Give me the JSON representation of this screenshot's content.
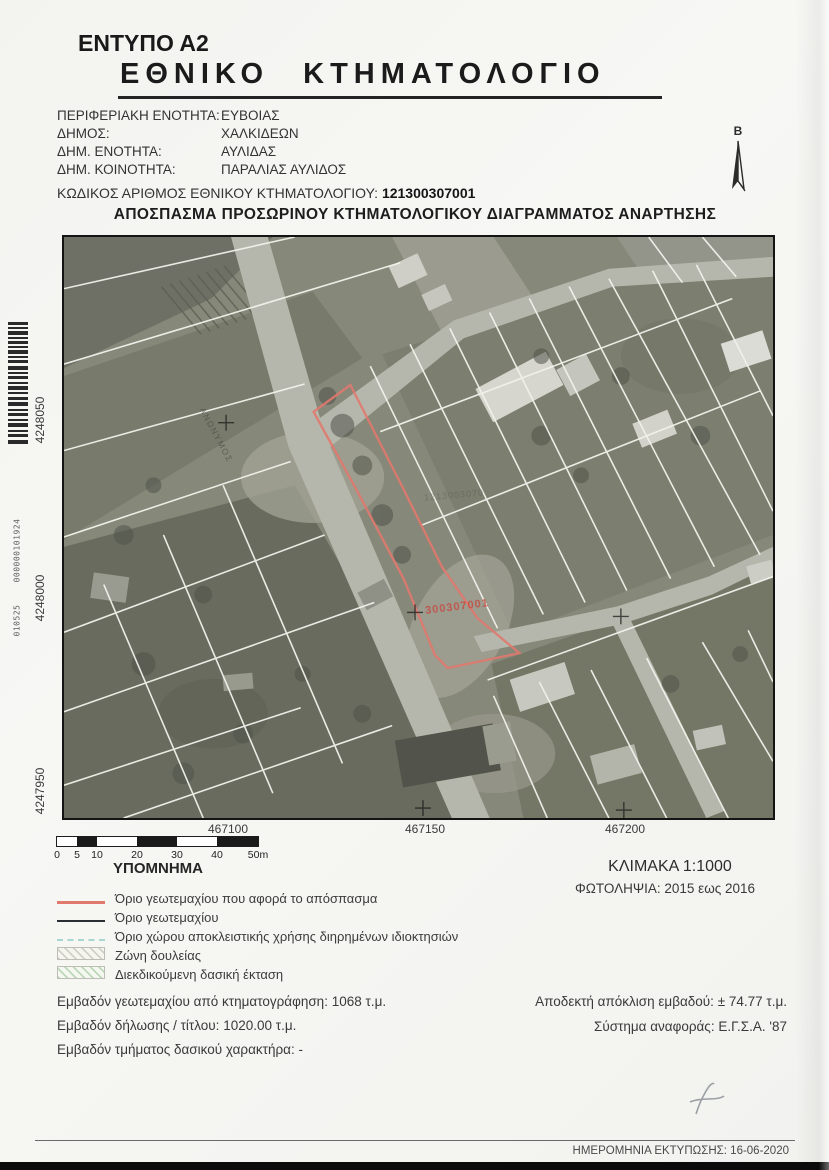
{
  "document": {
    "form_code": "ΕΝΤΥΠΟ Α2",
    "title": "ΕΘΝΙΚΟ ΚΤΗΜΑΤΟΛΟΓΙΟ",
    "map_title": "ΑΠΟΣΠΑΣΜΑ ΠΡΟΣΩΡΙΝΟΥ ΚΤΗΜΑΤΟΛΟΓΙΚΟΥ ΔΙΑΓΡΑΜΜΑΤΟΣ ΑΝΑΡΤΗΣΗΣ"
  },
  "admin": {
    "rows": [
      {
        "label": "ΠΕΡΙΦΕΡΙΑΚΗ ΕΝΟΤΗΤΑ:",
        "value": "ΕΥΒΟΙΑΣ"
      },
      {
        "label": "ΔΗΜΟΣ:",
        "value": "ΧΑΛΚΙΔΕΩΝ"
      },
      {
        "label": "ΔΗΜ. ΕΝΟΤΗΤΑ:",
        "value": "ΑΥΛΙΔΑΣ"
      },
      {
        "label": "ΔΗΜ. ΚΟΙΝΟΤΗΤΑ:",
        "value": "ΠΑΡΑΛΙΑΣ ΑΥΛΙΔΟΣ"
      }
    ],
    "kaek_label": "ΚΩΔΙΚΟΣ ΑΡΙΘΜΟΣ ΕΘΝΙΚΟΥ ΚΤΗΜΑΤΟΛΟΓΙΟΥ:",
    "kaek_value": "121300307001"
  },
  "map": {
    "north_label": "Β",
    "parcel_code_label": "300307001",
    "faint_parcel_code": "1213003070",
    "street_label": "ΑΝΩΝΥΜΟΣ",
    "x_ticks": [
      "467100",
      "467150",
      "467200"
    ],
    "y_ticks": [
      "4248050",
      "4248000",
      "4247950"
    ],
    "subject_outline_color": "#e0796e"
  },
  "scalebar": {
    "ticks": [
      "0",
      "5",
      "10",
      "20",
      "30",
      "40",
      "50m"
    ]
  },
  "legend": {
    "title": "ΥΠΟΜΝΗΜΑ",
    "items": [
      {
        "swatch": "red-line",
        "label": "Όριο γεωτεμαχίου που αφορά το απόσπασμα"
      },
      {
        "swatch": "dark-line",
        "label": "Όριο γεωτεμαχίου"
      },
      {
        "swatch": "teal-dashed-line",
        "label": "Όριο χώρου αποκλειστικής χρήσης διηρημένων ιδιοκτησιών"
      },
      {
        "swatch": "gray-hatch",
        "label": "Ζώνη δουλείας"
      },
      {
        "swatch": "green-hatch",
        "label": "Διεκδικούμενη δασική έκταση"
      }
    ]
  },
  "map_meta": {
    "scale": "ΚΛΙΜΑΚΑ 1:1000",
    "photo_dates": "ΦΩΤΟΛΗΨΙΑ: 2015 εως 2016"
  },
  "areas": {
    "left": [
      {
        "label": "Εμβαδόν γεωτεμαχίου από κτηματογράφηση:",
        "value": "1068 τ.μ."
      },
      {
        "label": "Εμβαδόν δήλωσης / τίτλου:",
        "value": "1020.00 τ.μ."
      },
      {
        "label": "Εμβαδόν τμήματος δασικού χαρακτήρα:",
        "value": "-"
      }
    ],
    "right": [
      {
        "label": "Αποδεκτή απόκλιση εμβαδού:",
        "value": "± 74.77 τ.μ."
      },
      {
        "label": "Σύστημα αναφοράς:",
        "value": "Ε.Γ.Σ.Α. '87"
      }
    ]
  },
  "footer": {
    "print_date": "ΗΜΕΡΟΜΗΝΙΑ ΕΚΤΥΠΩΣΗΣ: 16-06-2020"
  },
  "scan_artifacts": {
    "barcode_number": "000000101924",
    "batch_number": "010525"
  },
  "colors": {
    "subject_parcel": "#e0796e",
    "divided_use_line": "#a9d6d0",
    "footer_bar": "#0b0b0b"
  }
}
